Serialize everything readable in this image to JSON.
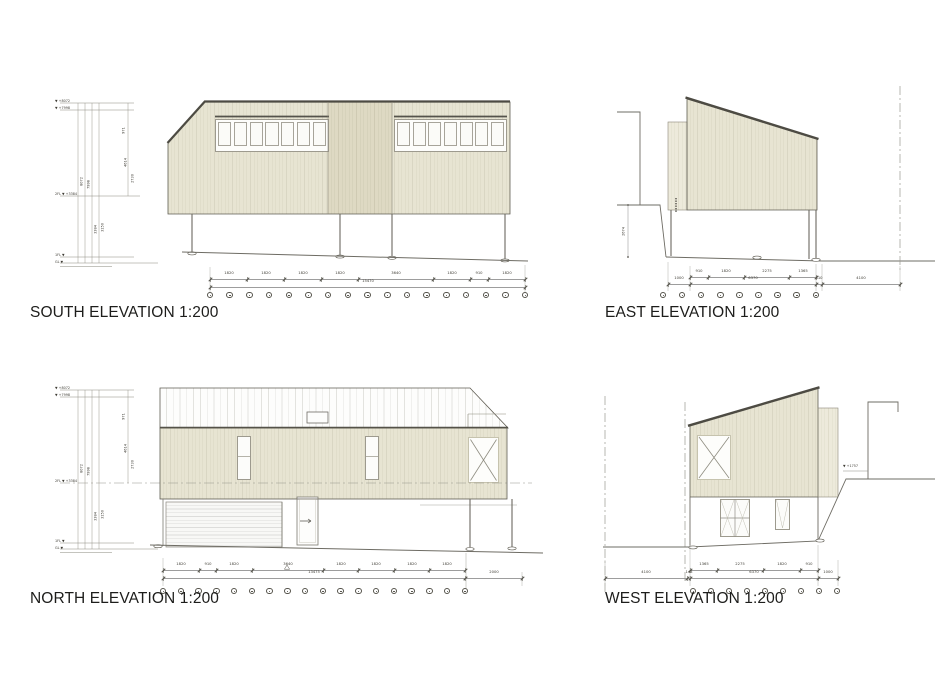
{
  "titles": {
    "south": "SOUTH ELEVATION 1:200",
    "east": "EAST ELEVATION 1:200",
    "north": "NORTH ELEVATION 1:200",
    "west": "WEST ELEVATION 1:200"
  },
  "colors": {
    "siding": "#e7e4d2",
    "siding_stripe": "#d9d6c3",
    "siding_dark": "#ded9c3",
    "roof_white": "#fdfdfc",
    "outline": "#5f5c52",
    "roof_edge": "#4d4b43",
    "dim_line": "#8c8c8c",
    "title_text": "#1d1d1b"
  },
  "south": {
    "levels": [
      "▼ +8072",
      "▼ +7998",
      "2FL ▼ +3384",
      "1FL ▼",
      "GL ▼"
    ],
    "rail_dims": [
      "8072",
      "7998",
      "971",
      "4614",
      "2730",
      "3384",
      "3150"
    ],
    "dims_row1": [
      "1820",
      "1820",
      "1820",
      "1820",
      "3640",
      "1820",
      "910",
      "1820"
    ],
    "dims_total": "15470"
  },
  "east": {
    "height_dim": "2674",
    "dims_row1": [
      "910",
      "1820",
      "2275",
      "1365"
    ],
    "dims_row2": [
      "1000",
      "6370",
      "310",
      "4100"
    ]
  },
  "north": {
    "levels": [
      "▼ +8072",
      "▼ +7998",
      "2FL ▼ +3384",
      "1FL ▼",
      "GL ▼"
    ],
    "rail_dims": [
      "8072",
      "7998",
      "971",
      "4614",
      "2730",
      "3384",
      "3150"
    ],
    "dims_row1": [
      "1820",
      "910",
      "1820",
      "3640",
      "1820",
      "1820",
      "1820",
      "1820"
    ],
    "dims_total": "13475",
    "dims_right": "2000"
  },
  "west": {
    "note": "▼ +1757",
    "dims_row1": [
      "1365",
      "2275",
      "1820",
      "910"
    ],
    "dims_row2": [
      "4100",
      "143",
      "6370",
      "1000"
    ]
  }
}
